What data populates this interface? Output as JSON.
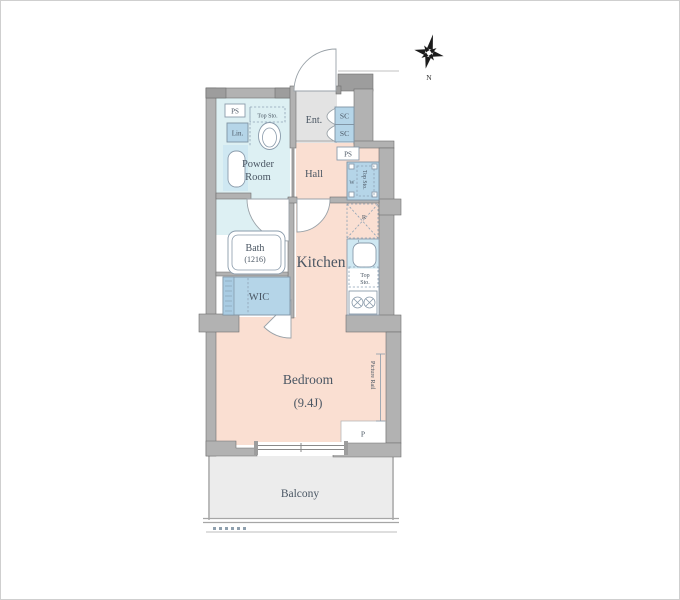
{
  "plan": {
    "rooms": {
      "entrance": "Ent.",
      "hall": "Hall",
      "powder_line1": "Powder",
      "powder_line2": "Room",
      "bath": "Bath",
      "bath_size": "(1216)",
      "wic": "WIC",
      "kitchen": "Kitchen",
      "bedroom": "Bedroom",
      "bedroom_size": "(9.4J)",
      "balcony": "Balcony"
    },
    "labels": {
      "ps_top": "PS",
      "ps_hall": "PS",
      "sc_top": "SC",
      "sc_bottom": "SC",
      "linen": "Lin.",
      "top_sto_toilet": "Top Sto.",
      "washer": "W",
      "top_sto_washer": "Top Sto.",
      "fridge": "R",
      "top_sto_kitchen_line1": "Top",
      "top_sto_kitchen_line2": "Sto.",
      "picture_rail": "Picture Rail",
      "pipe": "P",
      "compass_north": "N"
    },
    "colors": {
      "wall": "#b2b2b2",
      "living_floor": "#fadfd2",
      "wet_floor": "#ddf0f3",
      "closet": "#b5d5e8",
      "sink_counter": "#cfe8f2",
      "entrance_floor": "#e3e3e3",
      "balcony_floor": "#ececec",
      "label_text": "#4a5663"
    }
  }
}
